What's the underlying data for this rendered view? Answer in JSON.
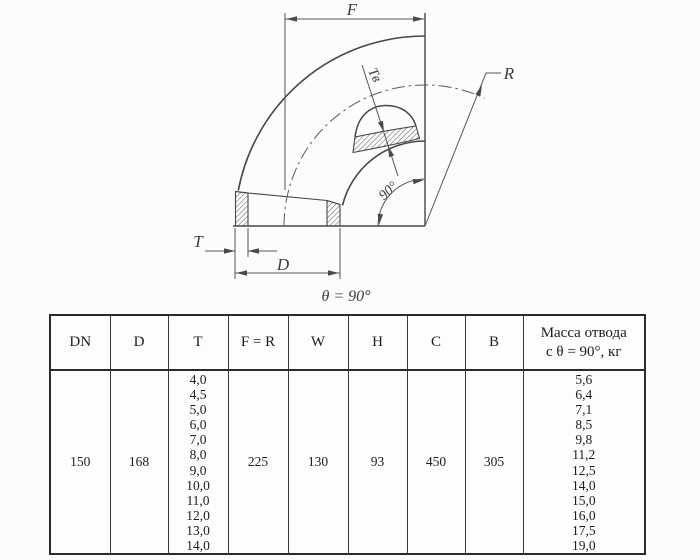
{
  "diagram": {
    "labels": {
      "f": "F",
      "r": "R",
      "t": "T",
      "d": "D",
      "tv": "Tв",
      "angle": "90°"
    },
    "caption": "θ = 90°"
  },
  "table": {
    "headers": [
      "DN",
      "D",
      "T",
      "F = R",
      "W",
      "H",
      "C",
      "B",
      "Масса отвода\nс θ =  90°, кг"
    ],
    "row": {
      "dn": "150",
      "d": "168",
      "t_values": [
        "4,0",
        "4,5",
        "5,0",
        "6,0",
        "7,0",
        "8,0",
        "9,0",
        "10,0",
        "11,0",
        "12,0",
        "13,0",
        "14,0"
      ],
      "f_r": "225",
      "w": "130",
      "h": "93",
      "c": "450",
      "b": "305",
      "mass_values": [
        "5,6",
        "6,4",
        "7,1",
        "8,5",
        "9,8",
        "11,2",
        "12,5",
        "14,0",
        "15,0",
        "16,0",
        "17,5",
        "19,0"
      ]
    }
  }
}
